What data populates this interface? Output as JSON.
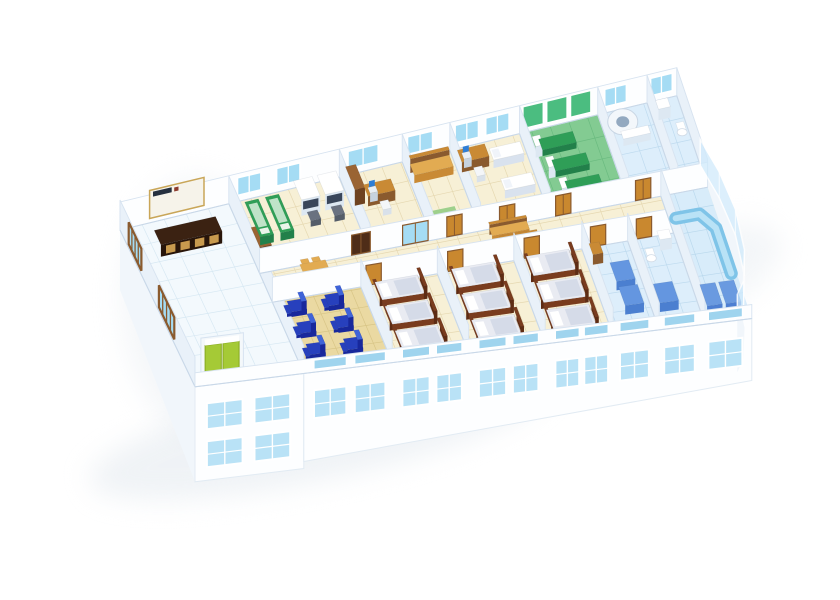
{
  "meta": {
    "title": "3D cutaway floor plan rendering of a clinic ward floor",
    "sign_logo_text": ""
  },
  "scene": {
    "projection": {
      "ox": 120,
      "oy": 230,
      "ux": 0.85,
      "uy": -0.205,
      "vx": 0.335,
      "vy": 0.7,
      "kuv": 0.00045,
      "wallH": 28,
      "corridorWallH": 25,
      "nearWallH": 14
    },
    "colors": {
      "wall": "#fdfeff",
      "wallEdge": "#d7e3f0",
      "wallSide": "#e9f1f9",
      "wallBase": "#c9d8e8",
      "baseFace": "#fdfeff",
      "baseEdge": "#e2ebf3",
      "baseSide": "#f1f6fb",
      "shadow": "#e3e9ef",
      "glass": "#a5dcf4",
      "glassStrip": "#9fd4ee",
      "facadeGlass": "#b9e2f6",
      "floorLobby": "#f3f9fd",
      "gridLobby": "#d5e7f2",
      "floorCream": "#f7f0d6",
      "gridCream": "#e4d6ae",
      "floorTan": "#ead9a2",
      "gridTan": "#d6c384",
      "floorGreen": "#83cb92",
      "gridGreen": "#68b97e",
      "floorBlue": "#ddeefb",
      "gridBlue": "#bcd9ee",
      "floorBlue2": "#d8ecfa",
      "gridBlue2": "#b8d7ec",
      "woodLight": "#e2ab52",
      "wood": "#c98a35",
      "woodDark": "#8a5a2e",
      "door": "#c9882f",
      "doorFrame": "#8a5a2e",
      "doorDark": "#4f2d18",
      "green": "#2f9e57",
      "greenDark": "#22804a",
      "greenPad": "#bfe3c8",
      "greenWall": "#4bbd80",
      "machineSide": "#dde8f2",
      "screenBlue": "#2e7ed6",
      "chairGray": "#6a7280",
      "reclinerBlue": "#2740bd",
      "reclinerDark": "#18289c",
      "reclinerLight": "#3f63d8",
      "bedFrame": "#7a3c1e",
      "bedFrameDark": "#5e2c14",
      "mattress": "#e9ebf2",
      "pillow": "#ffffff",
      "blanket": "#d5dbe8",
      "elevGreen": "#a5ca36",
      "elevDark": "#86a81e",
      "signBoard": "#f6f3ea",
      "signTrim": "#c9a658",
      "signLogo": "#26303f",
      "signLogoRed": "#8c3b2e",
      "counterTop": "#3b2212",
      "counterFront": "#28150a",
      "counterPanel": "#c89a4e",
      "ctRing": "#f3f7fb",
      "ctHole": "#93a9c0",
      "stallBlue": "#4b7fd0",
      "stallBlueTop": "#6496e0",
      "cabinetBlue": "#4d7fd2",
      "cabinetBlueTop": "#6a9ae0",
      "counterCurve": "#7fc4e8",
      "counterCurveLight": "#b9e2f6",
      "glassWall": "#cfeafc"
    },
    "building": {
      "length": 655,
      "depth": 224,
      "rowA_v": [
        0,
        92
      ],
      "corridor_v": [
        92,
        130
      ],
      "rowB_v": [
        130,
        224
      ]
    },
    "rooms": [
      {
        "id": "lobby",
        "band": "A",
        "u1": 0,
        "v1": 0,
        "u2": 128,
        "v2": 224,
        "floor": "floorLobby",
        "grid": "gridLobby",
        "step": 26,
        "furn": [
          {
            "t": "counter",
            "u": 30,
            "v": 26
          }
        ],
        "div": {
          "u": 128,
          "v1": 0,
          "v2": 224
        }
      },
      {
        "id": "treatment-room",
        "band": "A",
        "u1": 128,
        "v1": 0,
        "u2": 258,
        "v2": 92,
        "floor": "floorCream",
        "grid": "gridCream",
        "step": 22,
        "furn": [
          {
            "t": "woodcab",
            "u": 132,
            "v": 56,
            "w": 14,
            "d": 26,
            "h": 18
          },
          {
            "t": "gtable",
            "u": 142,
            "v": 12
          },
          {
            "t": "gtable",
            "u": 166,
            "v": 12
          },
          {
            "t": "machine",
            "u": 200,
            "v": 10
          },
          {
            "t": "machine",
            "u": 228,
            "v": 10
          }
        ],
        "div": {
          "u": 258,
          "v1": 0,
          "v2": 92
        }
      },
      {
        "id": "office",
        "band": "A",
        "u1": 258,
        "v1": 0,
        "u2": 332,
        "v2": 92,
        "floor": "floorCream",
        "grid": "gridCream",
        "step": 22,
        "furn": [
          {
            "t": "woodcab",
            "u": 262,
            "v": 8,
            "w": 12,
            "d": 28,
            "h": 16
          },
          {
            "t": "desk",
            "u": 276,
            "v": 26
          }
        ],
        "div": {
          "u": 332,
          "v1": 0,
          "v2": 92
        }
      },
      {
        "id": "rest-room",
        "band": "A",
        "u1": 332,
        "v1": 0,
        "u2": 388,
        "v2": 92,
        "floor": "floorCream",
        "grid": "gridCream",
        "step": 22,
        "furn": [
          {
            "t": "daybed",
            "u": 336,
            "v": 10
          },
          {
            "t": "mat",
            "u": 344,
            "v": 60,
            "w": 26,
            "d": 14
          }
        ],
        "div": {
          "u": 388,
          "v1": 0,
          "v2": 92
        }
      },
      {
        "id": "consult-room",
        "band": "A",
        "u1": 388,
        "v1": 0,
        "u2": 470,
        "v2": 92,
        "floor": "floorCream",
        "grid": "gridCream",
        "step": 22,
        "furn": [
          {
            "t": "desk",
            "u": 392,
            "v": 12
          },
          {
            "t": "couch",
            "u": 428,
            "v": 16
          },
          {
            "t": "couch",
            "u": 428,
            "v": 50
          }
        ],
        "div": {
          "u": 470,
          "v1": 0,
          "v2": 92
        }
      },
      {
        "id": "physio-room",
        "band": "A",
        "u1": 470,
        "v1": 0,
        "u2": 562,
        "v2": 92,
        "floor": "floorGreen",
        "grid": "gridGreen",
        "step": 22,
        "furn": [
          {
            "t": "ptable",
            "u": 486,
            "v": 16
          },
          {
            "t": "ptable",
            "u": 492,
            "v": 40
          },
          {
            "t": "ptable",
            "u": 498,
            "v": 64
          }
        ],
        "div": {
          "u": 562,
          "v1": 0,
          "v2": 92
        }
      },
      {
        "id": "ct-room",
        "band": "A",
        "u1": 562,
        "v1": 0,
        "u2": 620,
        "v2": 92,
        "floor": "floorBlue",
        "grid": "gridBlue",
        "step": 22,
        "furn": [
          {
            "t": "ct",
            "u": 572,
            "v": 12
          }
        ],
        "div": {
          "u": 620,
          "v1": 0,
          "v2": 92
        }
      },
      {
        "id": "toilet-far",
        "band": "A",
        "u1": 620,
        "v1": 0,
        "u2": 655,
        "v2": 92,
        "floor": "floorBlue",
        "grid": "gridBlue",
        "step": 22,
        "furn": [
          {
            "t": "sinkbox",
            "u": 626,
            "v": 10
          },
          {
            "t": "toilet",
            "u": 642,
            "v": 30
          }
        ],
        "div": {
          "u": 655,
          "v1": 0,
          "v2": 92
        }
      },
      {
        "id": "corridor",
        "band": "C",
        "u1": 128,
        "v1": 92,
        "u2": 655,
        "v2": 130,
        "floor": "floorCream",
        "grid": "gridCream",
        "step": 24,
        "furn": [
          {
            "t": "table4",
            "u": 172,
            "v": 100
          },
          {
            "t": "bench",
            "u": 396,
            "v": 95
          },
          {
            "t": "bench",
            "u": 402,
            "v": 112
          }
        ]
      },
      {
        "id": "infusion-room",
        "band": "B",
        "u1": 128,
        "v1": 130,
        "u2": 232,
        "v2": 224,
        "floor": "floorTan",
        "grid": "gridTan",
        "step": 22,
        "furn": [
          {
            "t": "recliner",
            "u": 142,
            "v": 138
          },
          {
            "t": "recliner",
            "u": 186,
            "v": 138
          },
          {
            "t": "recliner",
            "u": 142,
            "v": 166
          },
          {
            "t": "recliner",
            "u": 186,
            "v": 166
          },
          {
            "t": "recliner",
            "u": 142,
            "v": 194
          },
          {
            "t": "recliner",
            "u": 186,
            "v": 194
          }
        ],
        "div": {
          "u": 232,
          "v1": 130,
          "v2": 224
        }
      },
      {
        "id": "ward-1",
        "band": "B",
        "u1": 232,
        "v1": 130,
        "u2": 322,
        "v2": 224,
        "floor": "floorCream",
        "grid": "gridCream",
        "step": 22,
        "furn": [
          {
            "t": "bed",
            "u": 244,
            "v": 134
          },
          {
            "t": "bed",
            "u": 244,
            "v": 164
          },
          {
            "t": "bed",
            "u": 244,
            "v": 194
          }
        ],
        "div": {
          "u": 322,
          "v1": 130,
          "v2": 224
        }
      },
      {
        "id": "ward-2",
        "band": "B",
        "u1": 322,
        "v1": 130,
        "u2": 412,
        "v2": 224,
        "floor": "floorCream",
        "grid": "gridCream",
        "step": 22,
        "furn": [
          {
            "t": "bed",
            "u": 334,
            "v": 134
          },
          {
            "t": "bed",
            "u": 334,
            "v": 164
          },
          {
            "t": "bed",
            "u": 334,
            "v": 194
          }
        ],
        "div": {
          "u": 412,
          "v1": 130,
          "v2": 224
        }
      },
      {
        "id": "ward-3",
        "band": "B",
        "u1": 412,
        "v1": 130,
        "u2": 492,
        "v2": 224,
        "floor": "floorCream",
        "grid": "gridCream",
        "step": 22,
        "furn": [
          {
            "t": "bed",
            "u": 422,
            "v": 134
          },
          {
            "t": "bed",
            "u": 422,
            "v": 164
          },
          {
            "t": "bed",
            "u": 422,
            "v": 194
          }
        ],
        "div": {
          "u": 492,
          "v1": 130,
          "v2": 224
        }
      },
      {
        "id": "bath-1",
        "band": "B",
        "u1": 492,
        "v1": 130,
        "u2": 546,
        "v2": 224,
        "floor": "floorBlue",
        "grid": "gridBlue",
        "step": 20,
        "furn": [
          {
            "t": "nstand",
            "u": 498,
            "v": 136
          },
          {
            "t": "stall",
            "u": 514,
            "v": 158
          },
          {
            "t": "stall",
            "u": 514,
            "v": 184
          }
        ],
        "div": {
          "u": 546,
          "v1": 130,
          "v2": 224
        }
      },
      {
        "id": "bath-2",
        "band": "B",
        "u1": 546,
        "v1": 130,
        "u2": 600,
        "v2": 224,
        "floor": "floorBlue",
        "grid": "gridBlue",
        "step": 20,
        "furn": [
          {
            "t": "toilet",
            "u": 560,
            "v": 146
          },
          {
            "t": "sinkbox",
            "u": 578,
            "v": 136
          },
          {
            "t": "stall",
            "u": 554,
            "v": 186
          }
        ],
        "div": {
          "u": 600,
          "v1": 92,
          "v2": 224
        }
      },
      {
        "id": "nurse-lounge",
        "band": "B",
        "u1": 600,
        "v1": 92,
        "u2": 655,
        "v2": 224,
        "floor": "floorBlue2",
        "grid": "gridBlue2",
        "step": 22,
        "furn": [
          {
            "t": "curvedesk"
          },
          {
            "t": "cab",
            "u": 604,
            "v": 198
          },
          {
            "t": "cab",
            "u": 626,
            "v": 198
          }
        ]
      }
    ],
    "sign": {
      "u1": 34,
      "u2": 98
    },
    "elevator": {
      "u1": 10,
      "u2": 60
    },
    "farWindows": [
      [
        138,
        166
      ],
      [
        184,
        212
      ],
      [
        268,
        304
      ],
      [
        338,
        368
      ],
      [
        394,
        422
      ],
      [
        430,
        458
      ],
      [
        570,
        596
      ],
      [
        624,
        650
      ]
    ],
    "physioPanels": [
      [
        474,
        498
      ],
      [
        502,
        526
      ],
      [
        530,
        554
      ]
    ],
    "leftWindows": [
      [
        26,
        64
      ],
      [
        116,
        162
      ]
    ],
    "facadeWindows": [
      [
        140,
        178
      ],
      [
        188,
        224
      ],
      [
        244,
        276
      ],
      [
        284,
        314
      ],
      [
        334,
        366
      ],
      [
        374,
        404
      ],
      [
        424,
        452
      ],
      [
        458,
        486
      ],
      [
        500,
        534
      ],
      [
        552,
        588
      ],
      [
        604,
        644
      ]
    ],
    "lobbyBaseWindows": [
      [
        14,
        56
      ],
      [
        70,
        112
      ]
    ],
    "corridorDoorsFar": [
      {
        "u1": 236,
        "u2": 258,
        "c": "doorDark"
      },
      {
        "u1": 296,
        "u2": 326,
        "c": "glassDoor"
      },
      {
        "u1": 348,
        "u2": 366,
        "c": "door"
      },
      {
        "u1": 410,
        "u2": 428,
        "c": "door"
      },
      {
        "u1": 476,
        "u2": 494,
        "c": "door"
      },
      {
        "u1": 570,
        "u2": 588,
        "c": "door"
      }
    ],
    "corridorDoorsNear": [
      {
        "u1": 238,
        "u2": 256,
        "c": "door"
      },
      {
        "u1": 334,
        "u2": 352,
        "c": "door"
      },
      {
        "u1": 424,
        "u2": 442,
        "c": "door"
      },
      {
        "u1": 502,
        "u2": 520,
        "c": "door"
      },
      {
        "u1": 556,
        "u2": 574,
        "c": "door"
      }
    ],
    "glassCurve": [
      [
        655,
        70
      ],
      [
        664,
        104
      ],
      [
        668,
        142
      ],
      [
        663,
        182
      ],
      [
        650,
        212
      ],
      [
        638,
        224
      ]
    ],
    "curveDeskPath": [
      [
        608,
        116
      ],
      [
        636,
        116
      ],
      [
        649,
        132
      ],
      [
        649,
        178
      ]
    ],
    "shadows": [
      {
        "cx": 320,
        "cy": 432,
        "rx": 235,
        "ry": 48,
        "rot": -12,
        "op": 0.55
      },
      {
        "cx": 600,
        "cy": 312,
        "rx": 195,
        "ry": 55,
        "rot": -22,
        "op": 0.4
      },
      {
        "cx": 205,
        "cy": 310,
        "rx": 85,
        "ry": 135,
        "rot": -6,
        "op": 0.35
      }
    ]
  }
}
